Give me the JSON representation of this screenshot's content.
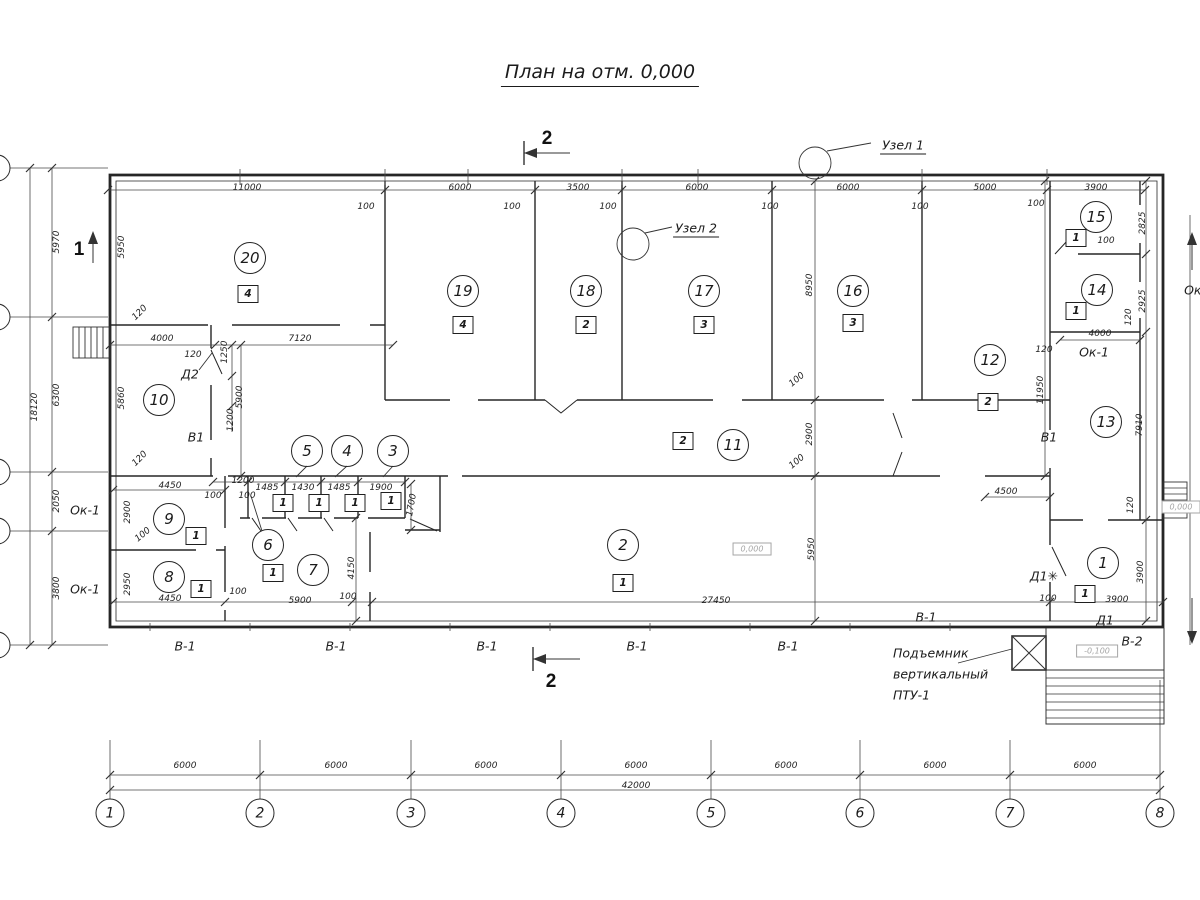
{
  "title": "План на отм. 0,000",
  "colors": {
    "line": "#262626",
    "dim": "#4a4a4a",
    "grey": "#a6a6a6"
  },
  "labels": [
    {
      "t": "11000",
      "x": 247,
      "y": 188
    },
    {
      "t": "6000",
      "x": 460,
      "y": 188
    },
    {
      "t": "3500",
      "x": 578,
      "y": 188
    },
    {
      "t": "6000",
      "x": 697,
      "y": 188
    },
    {
      "t": "6000",
      "x": 848,
      "y": 188
    },
    {
      "t": "5000",
      "x": 985,
      "y": 188
    },
    {
      "t": "3900",
      "x": 1096,
      "y": 188
    },
    {
      "t": "100",
      "x": 366,
      "y": 207
    },
    {
      "t": "100",
      "x": 512,
      "y": 207
    },
    {
      "t": "100",
      "x": 608,
      "y": 207
    },
    {
      "t": "100",
      "x": 770,
      "y": 207
    },
    {
      "t": "100",
      "x": 920,
      "y": 207
    },
    {
      "t": "100",
      "x": 1036,
      "y": 204
    },
    {
      "t": "6000",
      "x": 185,
      "y": 766
    },
    {
      "t": "6000",
      "x": 336,
      "y": 766
    },
    {
      "t": "6000",
      "x": 486,
      "y": 766
    },
    {
      "t": "6000",
      "x": 636,
      "y": 766
    },
    {
      "t": "6000",
      "x": 786,
      "y": 766
    },
    {
      "t": "6000",
      "x": 935,
      "y": 766
    },
    {
      "t": "6000",
      "x": 1085,
      "y": 766
    },
    {
      "t": "42000",
      "x": 636,
      "y": 786
    },
    {
      "t": "5970",
      "x": 57,
      "y": 242,
      "r": -90
    },
    {
      "t": "6300",
      "x": 57,
      "y": 395,
      "r": -90
    },
    {
      "t": "2050",
      "x": 57,
      "y": 501,
      "r": -90
    },
    {
      "t": "3800",
      "x": 57,
      "y": 588,
      "r": -90
    },
    {
      "t": "18120",
      "x": 35,
      "y": 407,
      "r": -90
    },
    {
      "t": "5950",
      "x": 122,
      "y": 247,
      "r": -90
    },
    {
      "t": "120",
      "x": 140,
      "y": 313,
      "r": -45
    },
    {
      "t": "5860",
      "x": 122,
      "y": 398,
      "r": -90
    },
    {
      "t": "120",
      "x": 140,
      "y": 459,
      "r": -45
    },
    {
      "t": "2900",
      "x": 128,
      "y": 512,
      "r": -90
    },
    {
      "t": "2950",
      "x": 128,
      "y": 584,
      "r": -90
    },
    {
      "t": "Ок-1",
      "x": 85,
      "y": 510,
      "c": "tag"
    },
    {
      "t": "Ок-1",
      "x": 85,
      "y": 589,
      "c": "tag"
    },
    {
      "t": "4000",
      "x": 162,
      "y": 339
    },
    {
      "t": "120",
      "x": 193,
      "y": 355
    },
    {
      "t": "7120",
      "x": 300,
      "y": 339
    },
    {
      "t": "Д2",
      "x": 190,
      "y": 374,
      "c": "tag"
    },
    {
      "t": "1250",
      "x": 225,
      "y": 352,
      "r": -90
    },
    {
      "t": "1200",
      "x": 231,
      "y": 420,
      "r": -90
    },
    {
      "t": "5900",
      "x": 240,
      "y": 397,
      "r": -90
    },
    {
      "t": "В1",
      "x": 196,
      "y": 437,
      "c": "tag"
    },
    {
      "t": "В1",
      "x": 1049,
      "y": 437,
      "c": "tag"
    },
    {
      "t": "4450",
      "x": 170,
      "y": 486
    },
    {
      "t": "100",
      "x": 213,
      "y": 496
    },
    {
      "t": "100",
      "x": 247,
      "y": 496
    },
    {
      "t": "1200",
      "x": 243,
      "y": 481
    },
    {
      "t": "1485",
      "x": 267,
      "y": 488
    },
    {
      "t": "1430",
      "x": 303,
      "y": 488
    },
    {
      "t": "1485",
      "x": 339,
      "y": 488
    },
    {
      "t": "1900",
      "x": 381,
      "y": 488
    },
    {
      "t": "1700",
      "x": 412,
      "y": 505,
      "r": -80
    },
    {
      "t": "100",
      "x": 143,
      "y": 535,
      "r": -40
    },
    {
      "t": "4450",
      "x": 170,
      "y": 599
    },
    {
      "t": "100",
      "x": 238,
      "y": 592
    },
    {
      "t": "5900",
      "x": 300,
      "y": 601
    },
    {
      "t": "100",
      "x": 348,
      "y": 597
    },
    {
      "t": "4150",
      "x": 352,
      "y": 568,
      "r": -90
    },
    {
      "t": "27450",
      "x": 716,
      "y": 601
    },
    {
      "t": "5950",
      "x": 812,
      "y": 549,
      "r": -90
    },
    {
      "t": "2900",
      "x": 810,
      "y": 434,
      "r": -90
    },
    {
      "t": "100",
      "x": 797,
      "y": 462,
      "r": -40
    },
    {
      "t": "100",
      "x": 797,
      "y": 380,
      "r": -40
    },
    {
      "t": "8950",
      "x": 810,
      "y": 285,
      "r": -90
    },
    {
      "t": "4500",
      "x": 1006,
      "y": 492
    },
    {
      "t": "11950",
      "x": 1041,
      "y": 390,
      "r": -90
    },
    {
      "t": "2825",
      "x": 1143,
      "y": 223,
      "r": -90
    },
    {
      "t": "100",
      "x": 1106,
      "y": 241
    },
    {
      "t": "2925",
      "x": 1143,
      "y": 301,
      "r": -90
    },
    {
      "t": "120",
      "x": 1129,
      "y": 317,
      "r": -90
    },
    {
      "t": "4000",
      "x": 1100,
      "y": 334
    },
    {
      "t": "Ок-1",
      "x": 1094,
      "y": 352,
      "c": "tag"
    },
    {
      "t": "120",
      "x": 1044,
      "y": 350
    },
    {
      "t": "7910",
      "x": 1140,
      "y": 425,
      "r": -90
    },
    {
      "t": "120",
      "x": 1131,
      "y": 505,
      "r": -90
    },
    {
      "t": "3900",
      "x": 1141,
      "y": 572,
      "r": -90
    },
    {
      "t": "3900",
      "x": 1117,
      "y": 600
    },
    {
      "t": "100",
      "x": 1048,
      "y": 599
    },
    {
      "t": "Д1✳",
      "x": 1044,
      "y": 576,
      "c": "tag"
    },
    {
      "t": "Д1",
      "x": 1105,
      "y": 620,
      "c": "tag"
    },
    {
      "t": "В-2",
      "x": 1132,
      "y": 641,
      "c": "tag"
    },
    {
      "t": "В-1",
      "x": 185,
      "y": 646,
      "c": "tag"
    },
    {
      "t": "В-1",
      "x": 336,
      "y": 646,
      "c": "tag"
    },
    {
      "t": "В-1",
      "x": 487,
      "y": 646,
      "c": "tag"
    },
    {
      "t": "В-1",
      "x": 637,
      "y": 646,
      "c": "tag"
    },
    {
      "t": "В-1",
      "x": 788,
      "y": 646,
      "c": "tag"
    },
    {
      "t": "В-1",
      "x": 926,
      "y": 617,
      "c": "tag"
    },
    {
      "t": "Ок-1",
      "x": 1199,
      "y": 290,
      "c": "tag"
    },
    {
      "t": "Узел 1",
      "x": 903,
      "y": 146,
      "c": "node"
    },
    {
      "t": "Узел 2",
      "x": 696,
      "y": 229,
      "c": "node"
    },
    {
      "t": "2",
      "x": 547,
      "y": 139,
      "c": "big"
    },
    {
      "t": "2",
      "x": 551,
      "y": 682,
      "c": "big"
    },
    {
      "t": "1",
      "x": 79,
      "y": 250,
      "c": "big"
    },
    {
      "t": "Подъемник",
      "x": 893,
      "y": 653,
      "c": "lift",
      "a": "l"
    },
    {
      "t": "вертикальный",
      "x": 893,
      "y": 674,
      "c": "lift",
      "a": "l"
    },
    {
      "t": "ПТУ-1",
      "x": 893,
      "y": 695,
      "c": "lift",
      "a": "l"
    },
    {
      "t": "0,000",
      "x": 752,
      "y": 549,
      "c": "grey"
    },
    {
      "t": "0,000",
      "x": 1181,
      "y": 507,
      "c": "grey"
    },
    {
      "t": "-0,100",
      "x": 1097,
      "y": 651,
      "c": "grey"
    }
  ],
  "room_bubbles": [
    {
      "n": "20",
      "x": 250,
      "y": 258
    },
    {
      "n": "19",
      "x": 463,
      "y": 291
    },
    {
      "n": "18",
      "x": 586,
      "y": 291
    },
    {
      "n": "17",
      "x": 704,
      "y": 291
    },
    {
      "n": "16",
      "x": 853,
      "y": 291
    },
    {
      "n": "15",
      "x": 1096,
      "y": 217
    },
    {
      "n": "14",
      "x": 1097,
      "y": 290
    },
    {
      "n": "13",
      "x": 1106,
      "y": 422
    },
    {
      "n": "12",
      "x": 990,
      "y": 360
    },
    {
      "n": "11",
      "x": 733,
      "y": 445
    },
    {
      "n": "10",
      "x": 159,
      "y": 400
    },
    {
      "n": "9",
      "x": 169,
      "y": 519
    },
    {
      "n": "8",
      "x": 169,
      "y": 577
    },
    {
      "n": "7",
      "x": 313,
      "y": 570
    },
    {
      "n": "6",
      "x": 268,
      "y": 545
    },
    {
      "n": "5",
      "x": 307,
      "y": 451
    },
    {
      "n": "4",
      "x": 347,
      "y": 451
    },
    {
      "n": "3",
      "x": 393,
      "y": 451
    },
    {
      "n": "2",
      "x": 623,
      "y": 545
    },
    {
      "n": "1",
      "x": 1103,
      "y": 563
    }
  ],
  "type_boxes": [
    {
      "n": "4",
      "x": 248,
      "y": 294
    },
    {
      "n": "4",
      "x": 463,
      "y": 325
    },
    {
      "n": "2",
      "x": 586,
      "y": 325
    },
    {
      "n": "3",
      "x": 704,
      "y": 325
    },
    {
      "n": "3",
      "x": 853,
      "y": 323
    },
    {
      "n": "2",
      "x": 988,
      "y": 402
    },
    {
      "n": "2",
      "x": 683,
      "y": 441
    },
    {
      "n": "1",
      "x": 623,
      "y": 583
    },
    {
      "n": "1",
      "x": 196,
      "y": 536
    },
    {
      "n": "1",
      "x": 201,
      "y": 589
    },
    {
      "n": "1",
      "x": 283,
      "y": 503
    },
    {
      "n": "1",
      "x": 319,
      "y": 503
    },
    {
      "n": "1",
      "x": 355,
      "y": 503
    },
    {
      "n": "1",
      "x": 391,
      "y": 501
    },
    {
      "n": "1",
      "x": 273,
      "y": 573
    },
    {
      "n": "1",
      "x": 1076,
      "y": 238
    },
    {
      "n": "1",
      "x": 1076,
      "y": 311
    },
    {
      "n": "1",
      "x": 1085,
      "y": 594
    }
  ],
  "grid_axes_bottom": {
    "y": 813,
    "items": [
      {
        "n": "1",
        "x": 110
      },
      {
        "n": "2",
        "x": 260
      },
      {
        "n": "3",
        "x": 411
      },
      {
        "n": "4",
        "x": 561
      },
      {
        "n": "5",
        "x": 711
      },
      {
        "n": "6",
        "x": 860
      },
      {
        "n": "7",
        "x": 1010
      },
      {
        "n": "8",
        "x": 1160
      }
    ]
  },
  "grid_axes_left": {
    "x": -3,
    "ys": [
      168,
      317,
      472,
      531,
      645
    ]
  }
}
